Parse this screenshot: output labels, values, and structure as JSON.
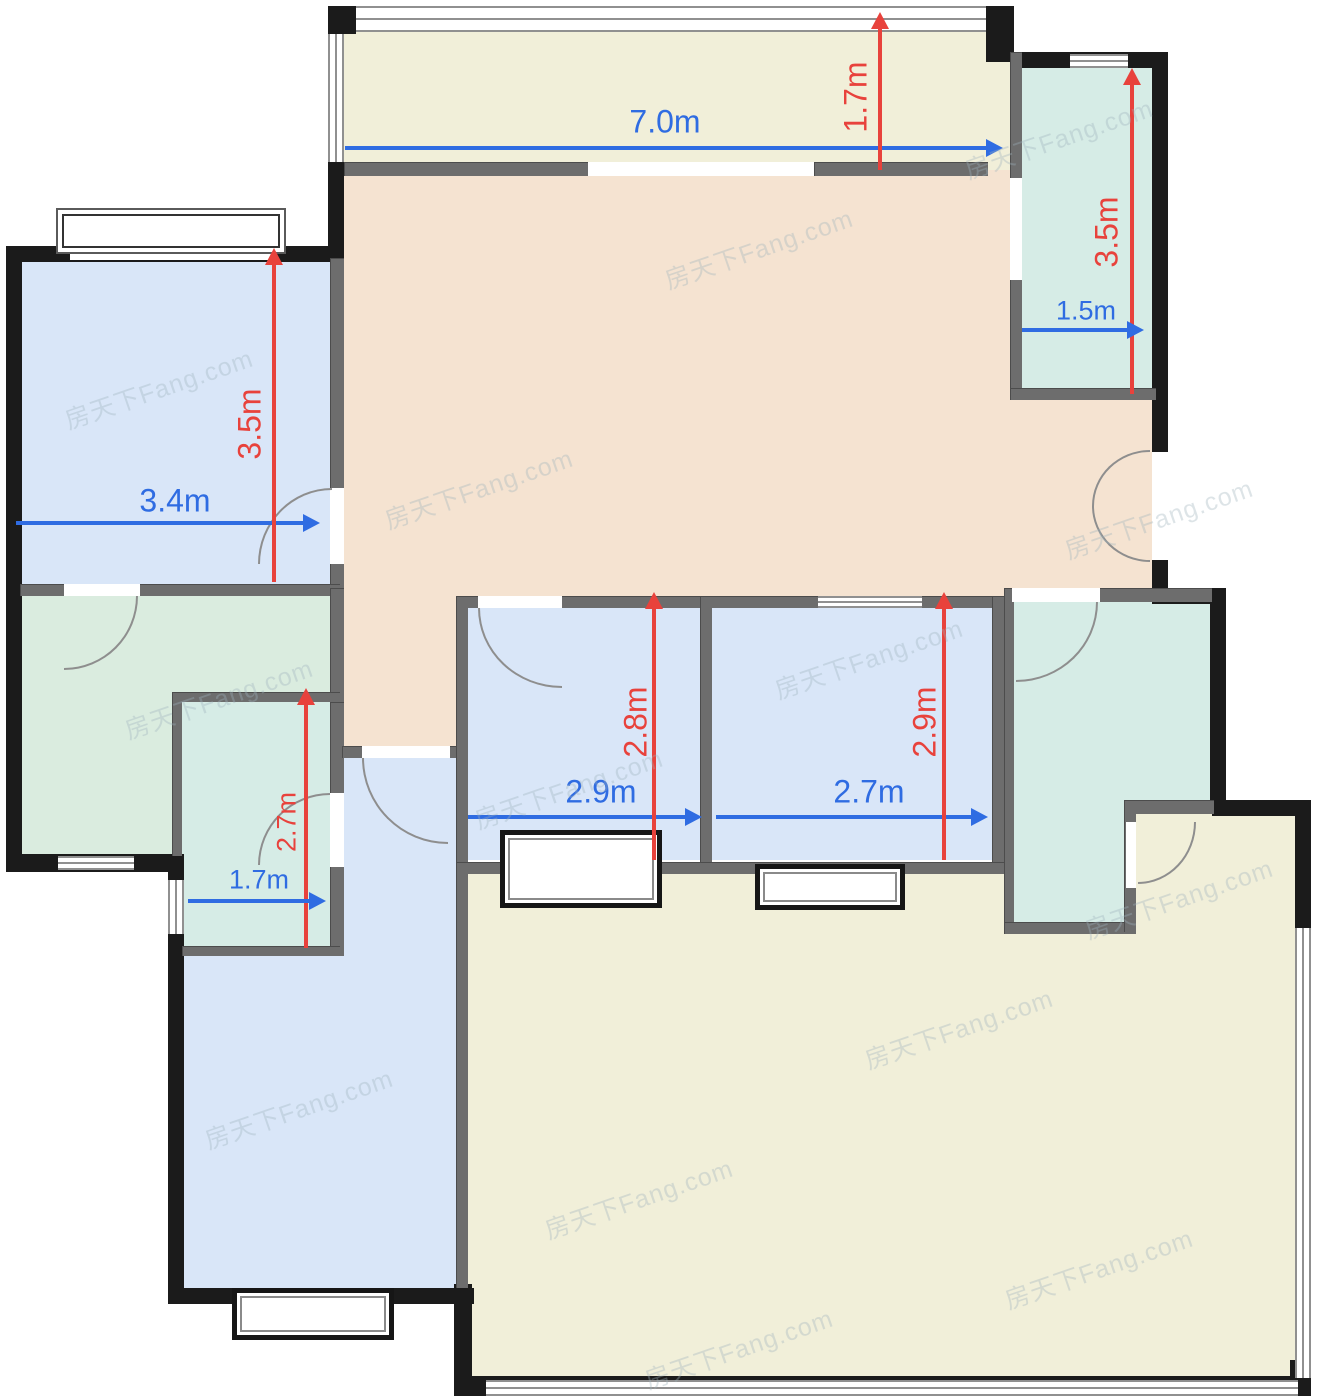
{
  "watermark": {
    "text": "房天下Fang.com"
  },
  "palette": {
    "wall_black": "#1b1b1b",
    "wall_gray": "#6d6d6d",
    "window_frame": "#909090",
    "arc_gray": "#8e8e8e",
    "dim_blue": "#2f6ce2",
    "dim_red": "#e8423c",
    "room_blue": "#d9e6f8",
    "room_teal": "#d6ece6",
    "room_green": "#daecdf",
    "room_tan": "#f5e3d1",
    "room_cream": "#f1efd9"
  },
  "dimensions": {
    "balcony_width": {
      "label": "7.0m",
      "axis": "horizontal"
    },
    "balcony_depth": {
      "label": "1.7m",
      "axis": "vertical"
    },
    "utility_top_right_height": {
      "label": "3.5m",
      "axis": "vertical"
    },
    "utility_top_right_width": {
      "label": "1.5m",
      "axis": "horizontal"
    },
    "bedroom_top_left_width": {
      "label": "3.4m",
      "axis": "horizontal"
    },
    "bedroom_top_left_height": {
      "label": "3.5m",
      "axis": "vertical"
    },
    "bathroom_left_height": {
      "label": "2.7m",
      "axis": "vertical"
    },
    "bathroom_left_width": {
      "label": "1.7m",
      "axis": "horizontal"
    },
    "bedroom_middle_width": {
      "label": "2.9m",
      "axis": "horizontal"
    },
    "bedroom_middle_height": {
      "label": "2.8m",
      "axis": "vertical"
    },
    "bedroom_right_width": {
      "label": "2.7m",
      "axis": "horizontal"
    },
    "bedroom_right_height": {
      "label": "2.9m",
      "axis": "vertical"
    }
  }
}
